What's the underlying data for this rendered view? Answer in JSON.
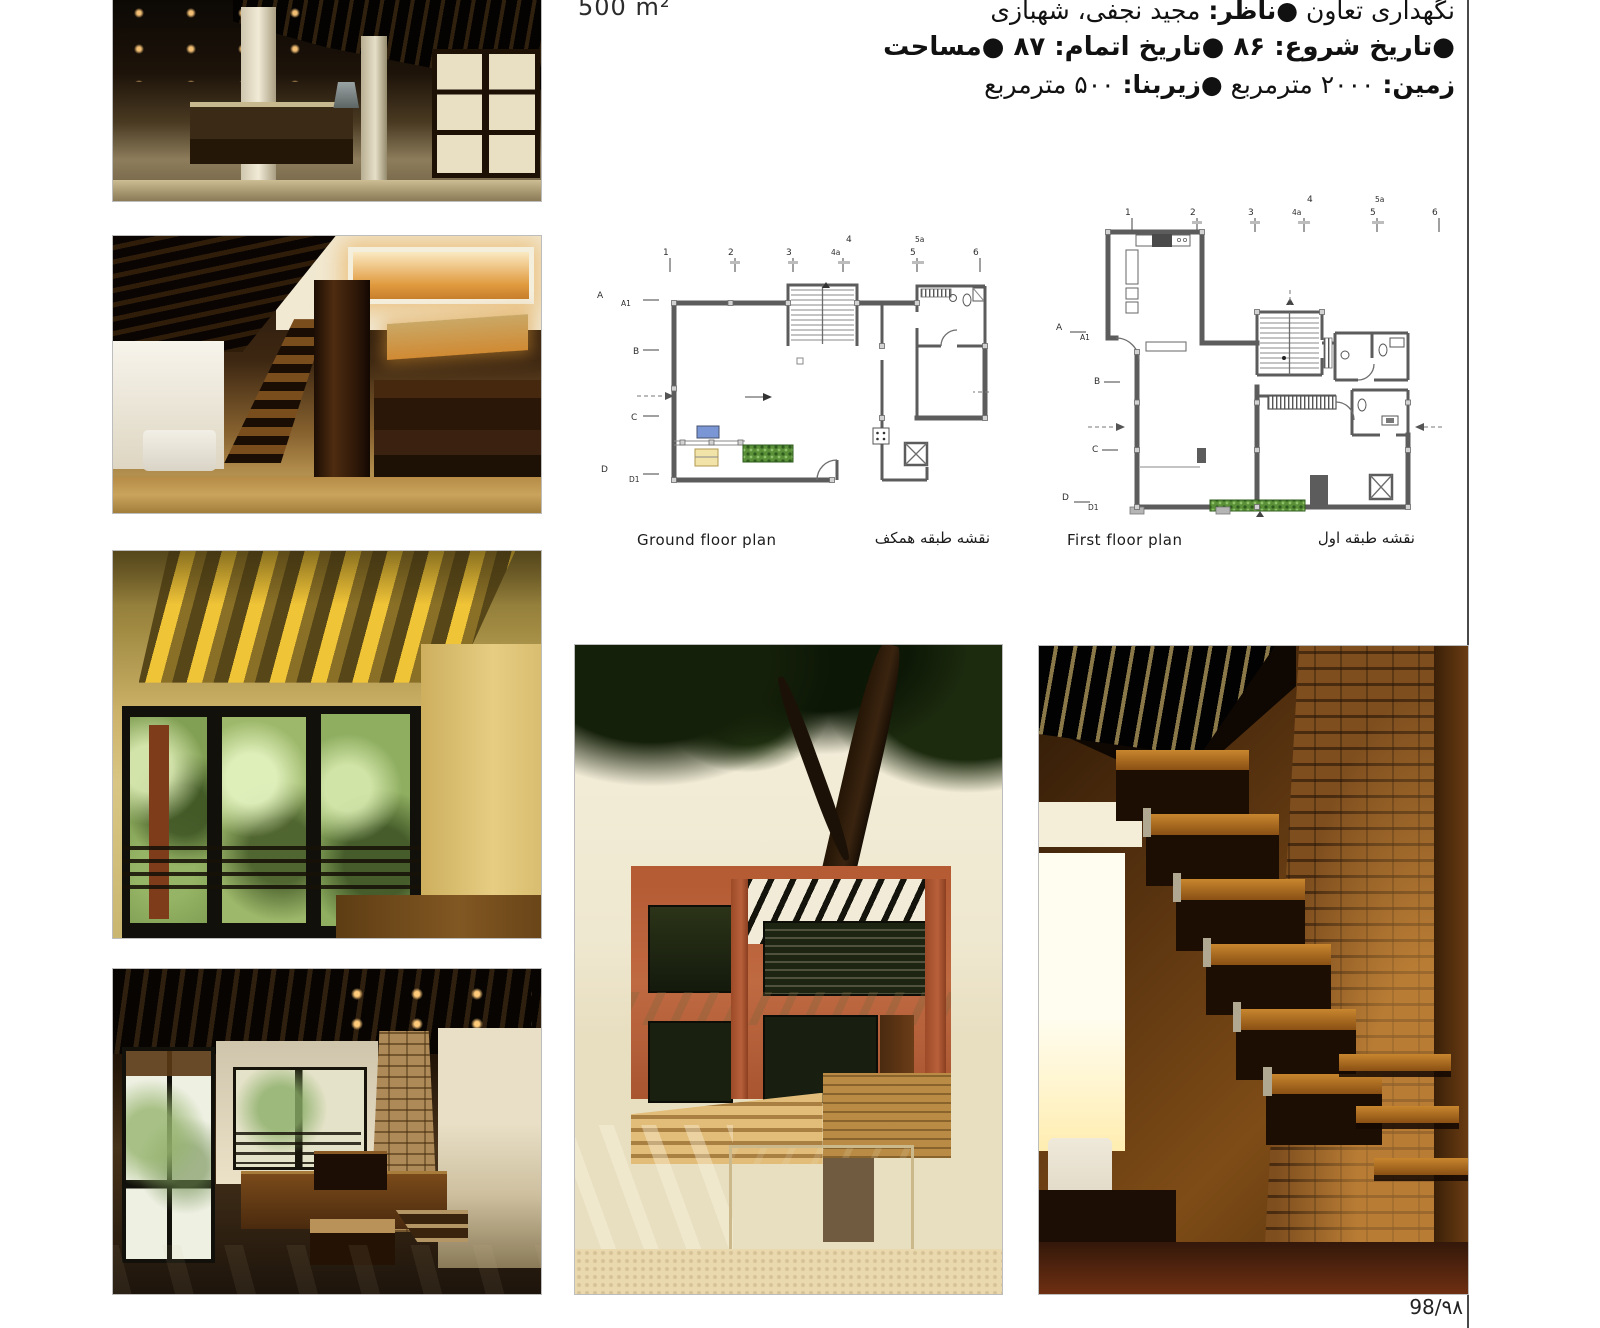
{
  "page": {
    "area_label": "500 m²",
    "page_number": "98/٩٨"
  },
  "header": {
    "line1_pre": "نگهداری تعاون ",
    "line1_bold": "●ناظر:",
    "line1_post": " مجید نجفی، شهبازی",
    "line2": "●تاریخ شروع: ۸۶ ●تاریخ اتمام: ۸۷ ●مساحت",
    "line3_bold1": "زمین:",
    "line3_text1": " ۲۰۰۰ مترمربع ",
    "line3_bold2": "●زیربنا:",
    "line3_text2": " ۵۰۰ مترمربع"
  },
  "plans": {
    "ground": {
      "caption_en": "Ground floor plan",
      "caption_fa": "نقشه طبقه همکف",
      "grid_top": [
        "1",
        "2",
        "3",
        "4a",
        "4",
        "5a",
        "5",
        "6"
      ],
      "grid_left": [
        "A",
        "A1",
        "B",
        "C",
        "D",
        "D1"
      ]
    },
    "first": {
      "caption_en": "First floor plan",
      "caption_fa": "نقشه طبقه اول",
      "grid_top": [
        "1",
        "2",
        "3",
        "4a",
        "4",
        "5a",
        "5",
        "6"
      ],
      "grid_left": [
        "A",
        "A1",
        "B",
        "C",
        "D",
        "D1"
      ]
    }
  },
  "colors": {
    "wall_gray": "#5c5c5c",
    "planter_green": "#5a9038",
    "furniture_blue": "#7b96d4",
    "furniture_yellow": "#f2e3a9",
    "rule_gray": "#4a4a4a"
  }
}
